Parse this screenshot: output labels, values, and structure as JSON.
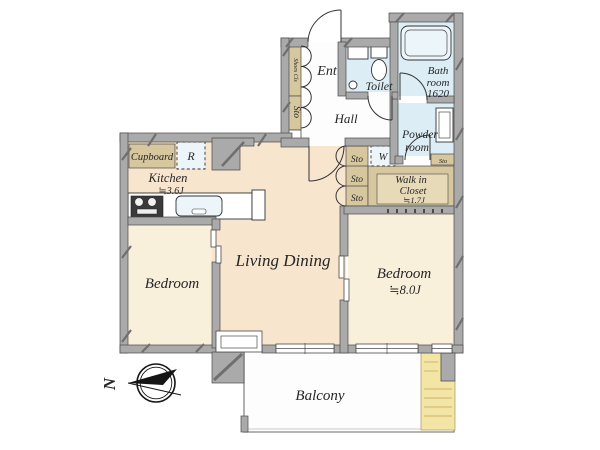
{
  "meta": {
    "type": "apartment-floor-plan"
  },
  "colors": {
    "wall": "#aaaaaa",
    "wall_hatch": "#6f6f6f",
    "outline": "#4a4a4a",
    "line": "#333333",
    "warm": "#f8e5cd",
    "cream": "#f9f0dc",
    "tan": "#d7c79f",
    "tan_inner": "#e6dab8",
    "blue": "#dcedf5",
    "fixture": "#ecf5fa",
    "floor_white": "#fdfdfd",
    "yellow": "#f3e5a5",
    "yellow_line": "#d9c47c",
    "text": "#262626",
    "dark": "#151515"
  },
  "rooms": {
    "ent": {
      "label": "Ent"
    },
    "hall": {
      "label": "Hall"
    },
    "toilet": {
      "label": "Toilet"
    },
    "bath": {
      "line1": "Bath",
      "line2": "room",
      "line3": "1620"
    },
    "powder": {
      "line1": "Powder",
      "line2": "room"
    },
    "kitchen": {
      "label": "Kitchen",
      "size": "≒3.6J"
    },
    "living": {
      "label": "Living Dining"
    },
    "bedroom_left": {
      "label": "Bedroom"
    },
    "bedroom_right": {
      "label": "Bedroom",
      "size": "≒8.0J"
    },
    "walkin": {
      "line1": "Walk in",
      "line2": "Closet",
      "size": "≒1.7J"
    },
    "balcony": {
      "label": "Balcony"
    }
  },
  "storage": {
    "shoes_closet": "Shoes Cls",
    "entry_sto": "Sto",
    "cupboard": "Cupboard",
    "refrigerator": "R",
    "washer": "W",
    "sto_1": "Sto",
    "sto_2": "Sto",
    "sto_3": "Sto",
    "powder_sto": "Sto"
  },
  "compass": {
    "north": "N"
  }
}
